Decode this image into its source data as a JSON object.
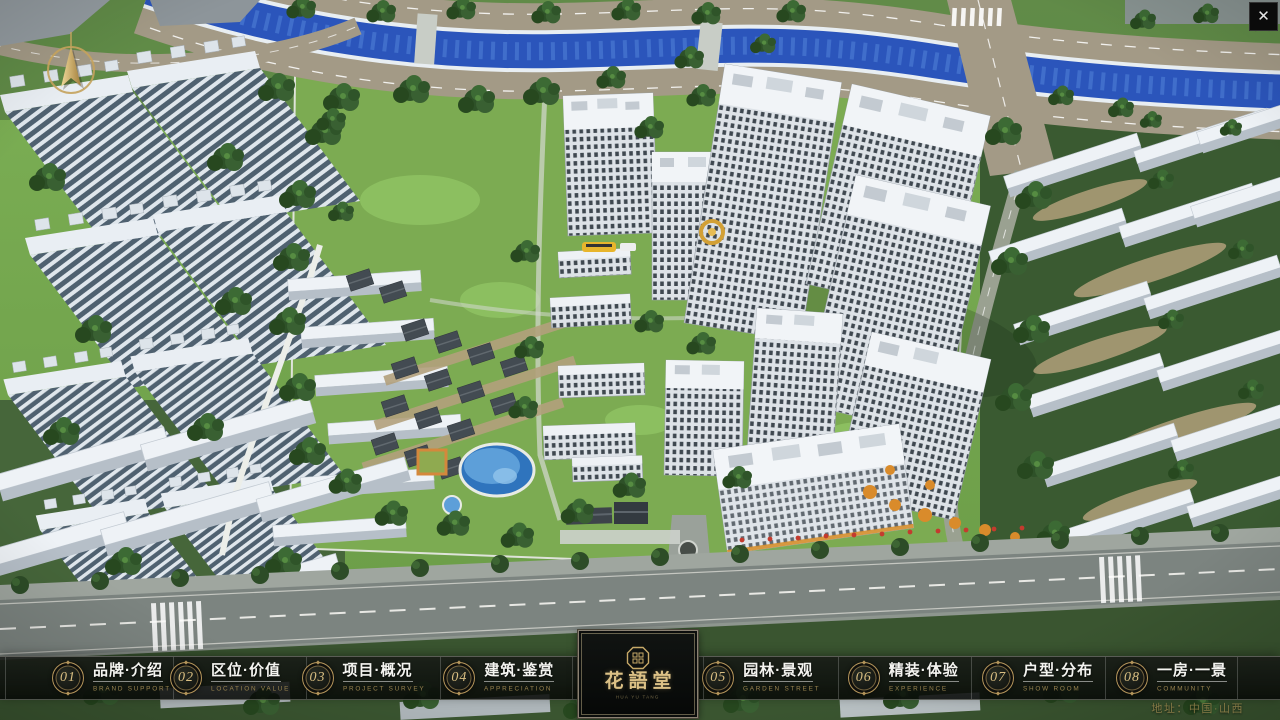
{
  "window": {
    "close_label": "✕"
  },
  "nav": {
    "items": [
      {
        "number": "01",
        "label_zh": "品牌·介绍",
        "label_en": "BRAND SUPPORT"
      },
      {
        "number": "02",
        "label_zh": "区位·价值",
        "label_en": "LOCATION VALUE"
      },
      {
        "number": "03",
        "label_zh": "项目·概况",
        "label_en": "PROJECT SURVEY"
      },
      {
        "number": "04",
        "label_zh": "建筑·鉴赏",
        "label_en": "APPRECIATION"
      },
      {
        "number": "05",
        "label_zh": "园林·景观",
        "label_en": "GARDEN STREET"
      },
      {
        "number": "06",
        "label_zh": "精装·体验",
        "label_en": "EXPERIENCE"
      },
      {
        "number": "07",
        "label_zh": "户型·分布",
        "label_en": "SHOW ROOM"
      },
      {
        "number": "08",
        "label_zh": "一房·一景",
        "label_en": "COMMUNITY"
      }
    ]
  },
  "logo": {
    "title": "花語堂",
    "subtitle": "HUA YU TANG"
  },
  "footer": {
    "address": "地址：中国·山西"
  },
  "icons": {
    "compass": "north-arrow-compass",
    "close": "close-x",
    "seal": "brand-seal-octagon"
  },
  "colors": {
    "gold": "#c9ab6b",
    "gold_dim": "#97824e",
    "bar_background": "rgba(10,12,10,0.8)",
    "label_text": "#f4f4f0",
    "river_blue": "#2b55bb",
    "grass_green": "#76a84f"
  }
}
